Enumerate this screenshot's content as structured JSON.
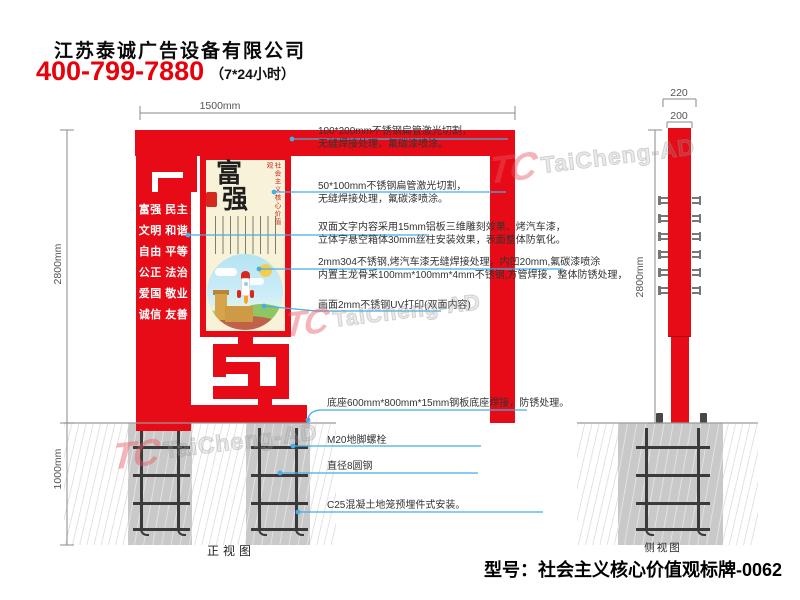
{
  "header": {
    "company": "江苏泰诚广告设备有限公司",
    "phone": "400-799-7880",
    "hours": "（7*24小时）"
  },
  "front_view": {
    "caption": "正视图",
    "dim_width": "1500mm",
    "dim_height": "2800mm",
    "dim_depth": "1000mm",
    "sign": {
      "values": [
        "富强 民主",
        "文明 和谐",
        "自由 平等",
        "公正 法治",
        "爱国 敬业",
        "诚信 友善"
      ],
      "panel_title_char1": "富",
      "panel_title_char2": "强",
      "panel_caption": "社会主义核心价值观"
    }
  },
  "side_view": {
    "caption": "侧视图",
    "dim_outer": "220",
    "dim_inner": "200",
    "dim_height": "2800mm"
  },
  "annotations": [
    {
      "l1": "100*200mm不锈钢扁管激光切割，",
      "l2": "无缝焊接处理，氟碳漆喷涂。"
    },
    {
      "l1": "50*100mm不锈钢扁管激光切割，",
      "l2": "无缝焊接处理，氟碳漆喷涂。"
    },
    {
      "l1": "双面文字内容采用15mm铝板三维雕刻效果、烤汽车漆，",
      "l2": "立体字悬空箱体30mm丝柱安装效果，表面整体防氧化。"
    },
    {
      "l1": "2mm304不锈钢,烤汽车漆无缝焊接处理，内凹20mm,氟碳漆喷涂",
      "l2": "内置主龙骨采100mm*100mm*4mm不锈钢,方管焊接，整体防锈处理，"
    },
    {
      "l1": "画面2mm不锈钢UV打印(双面内容)"
    },
    {
      "l1": "底座600mm*800mm*15mm钢板底座焊接，防锈处理。"
    },
    {
      "l1": "M20地脚螺栓"
    },
    {
      "l1": "直径8圆钢"
    },
    {
      "l1": "C25混凝土地笼预埋件式安装。"
    }
  ],
  "model_label": "型号：社会主义核心价值观标牌-0062",
  "watermark": {
    "logo": "TC",
    "name": "TaiCheng-AD"
  },
  "colors": {
    "sign_red": "#e60b16",
    "panel_cream": "#f8f3d8",
    "leader_blue": "#45aee6",
    "phone_red": "#e8000b",
    "foundation_gray": "#c9c9c9"
  }
}
